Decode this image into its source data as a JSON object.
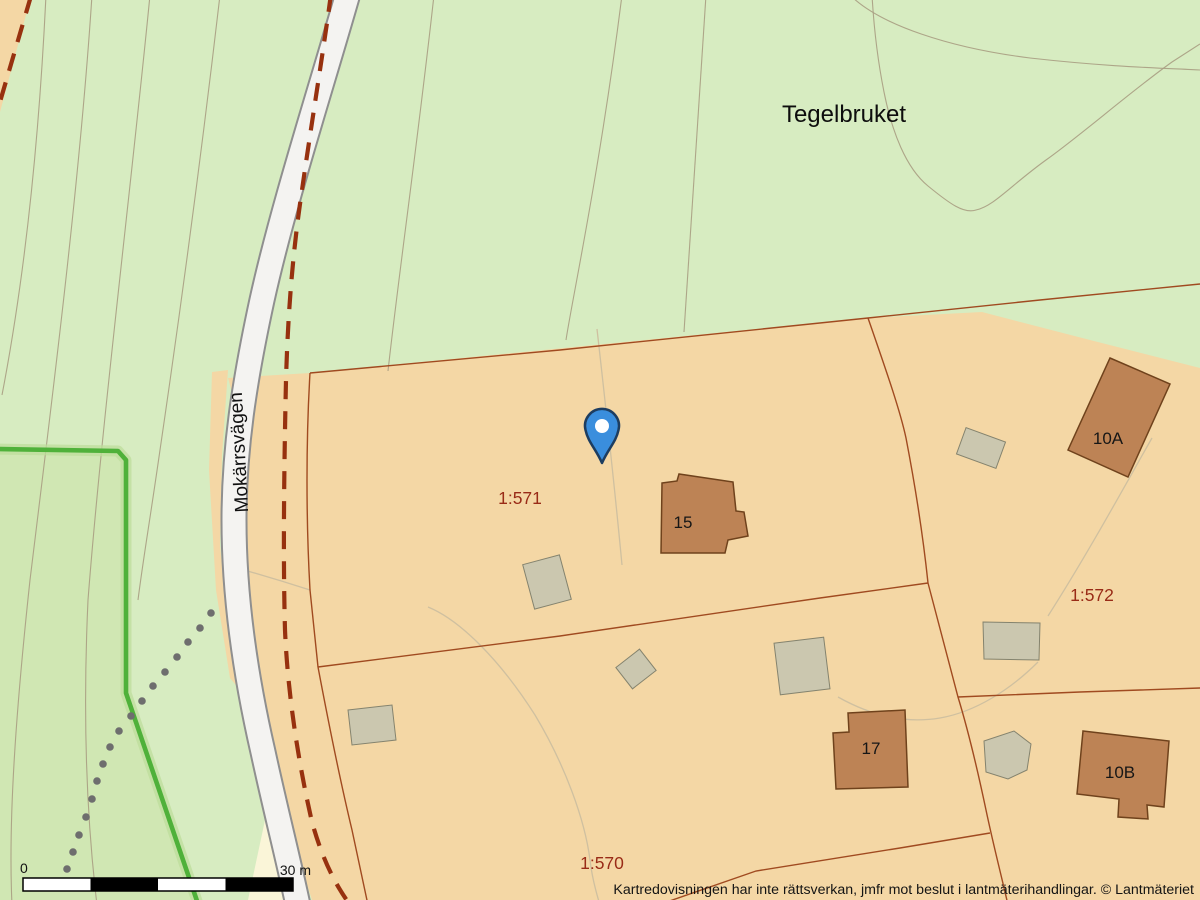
{
  "map": {
    "place_label": "Tegelbruket",
    "road_label": "Mokärrsvägen",
    "parcel_labels": {
      "p571": "1:571",
      "p572": "1:572",
      "p570": "1:570"
    },
    "building_labels": {
      "b15": "15",
      "b17": "17",
      "b10a": "10A",
      "b10b": "10B"
    },
    "scale_bar": {
      "start_label": "0",
      "end_label": "30 m"
    },
    "attribution": "Kartredovisningen har inte rättsverkan, jmfr mot beslut i lantmäterihandlingar. © Lantmäteriet",
    "marker": {
      "type": "map-pin",
      "color": "#3a8edd"
    },
    "colors": {
      "forest_green": "#d7ecc1",
      "forest_green_dark": "#c9e2a6",
      "parcel_orange": "#f4d7a5",
      "building_brown": "#bd8355",
      "outbuilding_gray": "#cbc7af",
      "road_white": "#f4f3f1",
      "road_casing": "#8f8f8f",
      "boundary_dashed_red": "#97310f",
      "cadastral_line": "#a04a20",
      "parcel_label_red": "#992b17",
      "trail_green": "#4fb13a",
      "footpath_dotted_gray": "#6e6e6e",
      "cream": "#faf5d8",
      "pin_blue": "#3a8edd"
    }
  }
}
